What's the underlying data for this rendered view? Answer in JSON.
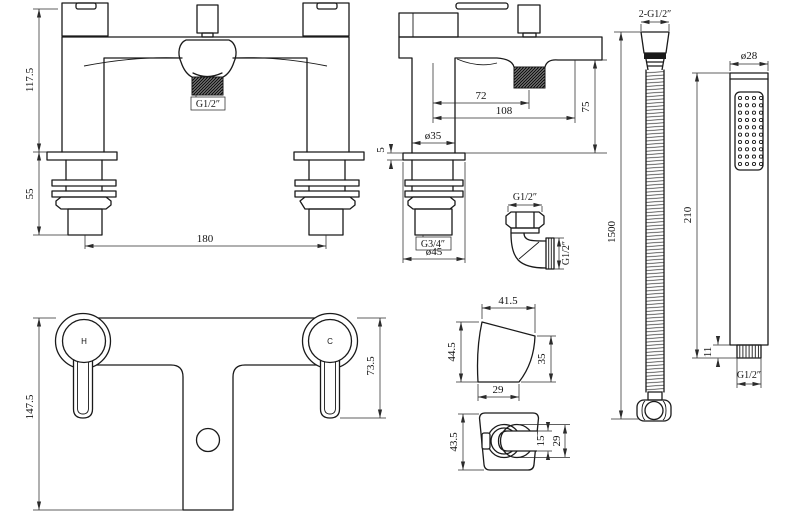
{
  "colors": {
    "line": "#1a1a1a",
    "dimension": "#2b2b2b",
    "background": "#ffffff"
  },
  "drawing_labels": {
    "front": {
      "total_height": "117.5",
      "shank_length": "55",
      "hole_centres": "180",
      "spout_thread": "G1/2″"
    },
    "side": {
      "spout_centre": "72",
      "overall_reach": "108",
      "deck_height": "75",
      "body_dia": "ø35",
      "deck_plate": "5",
      "inlet_thread": "G3/4″",
      "base_dia": "ø45"
    },
    "elbow": {
      "thread_top": "G1/2″",
      "thread_side": "G1/2″"
    },
    "hose": {
      "connections": "2-G1/2″",
      "length": "1500"
    },
    "handset": {
      "head_dia": "ø28",
      "length": "210",
      "connector_height": "11",
      "connector_thread": "G1/2″"
    },
    "plan": {
      "depth": "147.5",
      "handle_projection": "73.5",
      "hot_label": "H",
      "cold_label": "C"
    },
    "bracket_side": {
      "top_width": "41.5",
      "height": "44.5",
      "front_height": "35",
      "base_width": "29"
    },
    "bracket_front": {
      "height": "43.5",
      "clip_bore": "15",
      "ring_dia": "29"
    }
  }
}
